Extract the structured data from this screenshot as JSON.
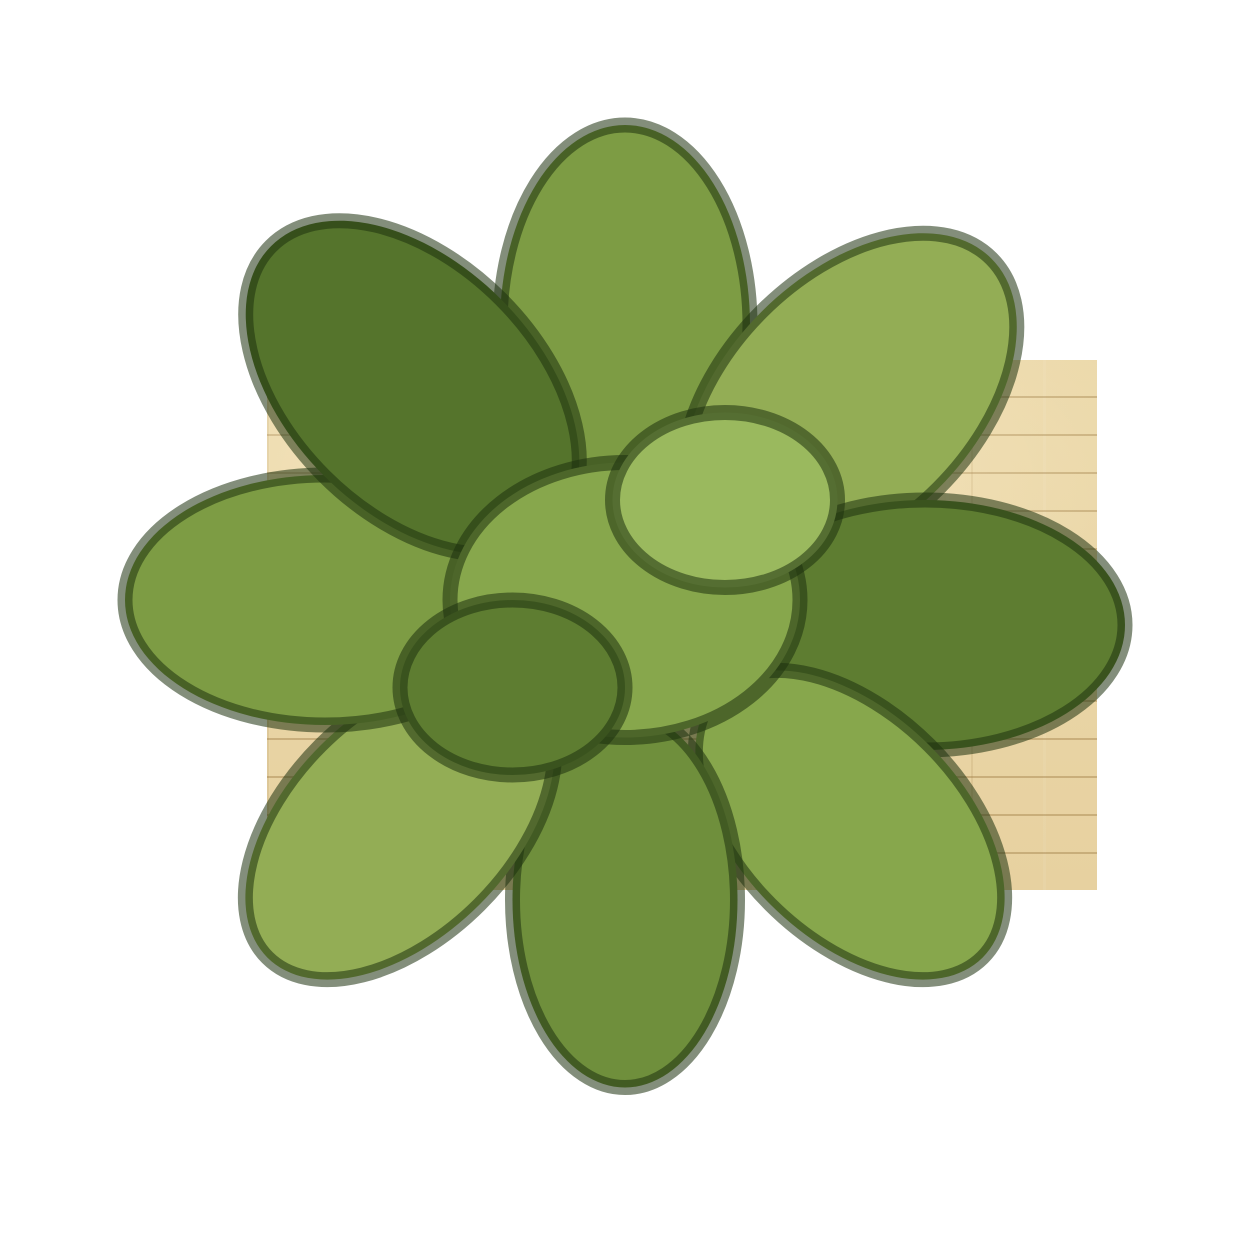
{
  "scene": {
    "type": "top-down 3D rendered floor plan of a studio apartment",
    "background_color": "#ffffff",
    "visible_text": "none"
  },
  "labels": {
    "floor_plan": "studio apartment floor plan",
    "living_area": "living and sleeping area with wood plank floor",
    "bathroom": "bathroom",
    "kitchen": "kitchenette strip",
    "balcony": "balcony",
    "entry": "entry corridor",
    "entry_door": "entrance sliding door with handle",
    "sofa": "two-seat cream sofa",
    "coffee_table": "coffee table with branch decor and magazine",
    "decor_branch": "dark branch decoration",
    "magazine": "open magazine",
    "nightstand": "wooden nightstand",
    "bed": "double bed",
    "headboard": "wooden headboard",
    "pillows": "two white pillows and two cream pillows",
    "blanket": "beige-brown plaid blanket",
    "fridge": "refrigerator",
    "counter": "kitchen counter",
    "cooktop": "two-burner cooktop",
    "kitchen_sink": "kitchen sink",
    "kitchen_mat": "textured kitchen mat",
    "side_table": "white side table",
    "bench": "low wooden cabinet bench",
    "plant": "green potted plant",
    "toilet": "toilet with tank and flush button",
    "shower": "tiled shower area with shower head and hooks",
    "glass_partition": "shower glass partition",
    "vanity": "bathroom vanity with basin and faucet",
    "bath_door": "bathroom sliding door with metal clips",
    "washer": "top-load washing machine",
    "closet": "dark entry closet",
    "balcony_door": "balcony door marker"
  },
  "palette": {
    "wood_floor": "#e8d3a3",
    "wood_floor_shadow": "#c89a55",
    "wall": "#efede8",
    "wall_bright": "#f5f4f0",
    "bathroom_tile_warm": "#e0c285",
    "bathroom_tile_dark": "#6e6355",
    "balcony_frame": "#0b0805",
    "balcony_wood": "#8d6e41",
    "sofa_cream": "#f1e9d4",
    "bed_linen": "#ece7d9",
    "plaid_base": "#ebdfc2",
    "plaid_stripe": "#8d7c58",
    "plant_green": "#7d9c44",
    "closet_dark": "#1a140d",
    "appliance_white": "#ebe8e2",
    "bench_wood": "#d9a95f"
  }
}
